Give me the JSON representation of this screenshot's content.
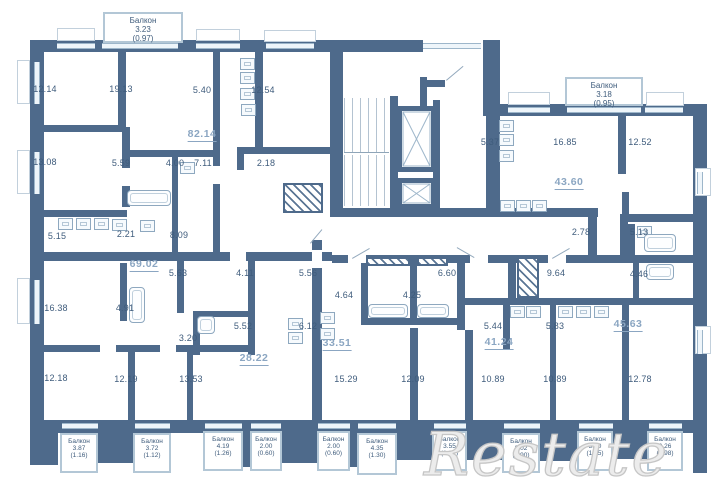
{
  "colors": {
    "wall": "#4e6a8b",
    "room_text": "#3f5c7c",
    "apartment_accent": "#8ba6c2",
    "window": "#9db6ca",
    "watermark": "#c6c6c6"
  },
  "watermark": {
    "text": "Restate"
  },
  "rooms": [
    {
      "label": "12.14",
      "x": 73,
      "y": 90
    },
    {
      "label": "19.13",
      "x": 149,
      "y": 90
    },
    {
      "label": "5.40",
      "x": 230,
      "y": 91
    },
    {
      "label": "12.54",
      "x": 291,
      "y": 91
    },
    {
      "label": "13.08",
      "x": 73,
      "y": 163
    },
    {
      "label": "5.59",
      "x": 149,
      "y": 164
    },
    {
      "label": "4.00",
      "x": 203,
      "y": 164
    },
    {
      "label": "7.11",
      "x": 231,
      "y": 164
    },
    {
      "label": "2.18",
      "x": 294,
      "y": 164
    },
    {
      "label": "5.15",
      "x": 85,
      "y": 237
    },
    {
      "label": "2.21",
      "x": 154,
      "y": 235
    },
    {
      "label": "8.09",
      "x": 207,
      "y": 236
    },
    {
      "label": "5.37",
      "x": 518,
      "y": 143
    },
    {
      "label": "16.85",
      "x": 593,
      "y": 143
    },
    {
      "label": "12.52",
      "x": 668,
      "y": 143
    },
    {
      "label": "2.78",
      "x": 609,
      "y": 233
    },
    {
      "label": "5.13",
      "x": 667,
      "y": 233
    },
    {
      "label": "5.63",
      "x": 206,
      "y": 274
    },
    {
      "label": "4.11",
      "x": 273,
      "y": 274
    },
    {
      "label": "5.56",
      "x": 336,
      "y": 274
    },
    {
      "label": "6.60",
      "x": 475,
      "y": 274
    },
    {
      "label": "9.64",
      "x": 584,
      "y": 274
    },
    {
      "label": "4.46",
      "x": 667,
      "y": 275
    },
    {
      "label": "16.38",
      "x": 84,
      "y": 309
    },
    {
      "label": "4.91",
      "x": 153,
      "y": 309
    },
    {
      "label": "4.64",
      "x": 372,
      "y": 296
    },
    {
      "label": "4.25",
      "x": 440,
      "y": 296
    },
    {
      "label": "3.20",
      "x": 216,
      "y": 339
    },
    {
      "label": "5.52",
      "x": 271,
      "y": 327
    },
    {
      "label": "6.12",
      "x": 336,
      "y": 327
    },
    {
      "label": "5.44",
      "x": 521,
      "y": 327
    },
    {
      "label": "5.83",
      "x": 583,
      "y": 327
    },
    {
      "label": "12.18",
      "x": 84,
      "y": 379
    },
    {
      "label": "12.19",
      "x": 154,
      "y": 380
    },
    {
      "label": "13.53",
      "x": 219,
      "y": 380
    },
    {
      "label": "15.29",
      "x": 374,
      "y": 380
    },
    {
      "label": "12.09",
      "x": 441,
      "y": 380
    },
    {
      "label": "10.89",
      "x": 521,
      "y": 380
    },
    {
      "label": "10.89",
      "x": 583,
      "y": 380
    },
    {
      "label": "12.78",
      "x": 668,
      "y": 380
    }
  ],
  "apartments": [
    {
      "label": "82.14",
      "x": 202,
      "y": 135
    },
    {
      "label": "43.60",
      "x": 569,
      "y": 183
    },
    {
      "label": "69.02",
      "x": 144,
      "y": 265
    },
    {
      "label": "33.51",
      "x": 337,
      "y": 344
    },
    {
      "label": "28.22",
      "x": 254,
      "y": 359
    },
    {
      "label": "41.24",
      "x": 499,
      "y": 343
    },
    {
      "label": "45.63",
      "x": 628,
      "y": 325
    }
  ],
  "balconies_top": [
    {
      "name": "Балкон",
      "area": "3.23",
      "reduced": "(0.97)",
      "x": 103,
      "y": 12,
      "w": 80,
      "h": 31
    },
    {
      "name": "Балкон",
      "area": "3.18",
      "reduced": "(0.95)",
      "x": 565,
      "y": 77,
      "w": 78,
      "h": 29
    }
  ],
  "balconies_bottom": [
    {
      "name": "Балкон",
      "area": "3.87",
      "reduced": "(1.16)",
      "x": 60,
      "y": 433,
      "w": 38,
      "h": 40
    },
    {
      "name": "Балкон",
      "area": "3.72",
      "reduced": "(1.12)",
      "x": 133,
      "y": 433,
      "w": 38,
      "h": 40
    },
    {
      "name": "Балкон",
      "area": "4.19",
      "reduced": "(1.26)",
      "x": 203,
      "y": 431,
      "w": 40,
      "h": 40
    },
    {
      "name": "Балкон",
      "area": "2.00",
      "reduced": "(0.60)",
      "x": 250,
      "y": 431,
      "w": 32,
      "h": 40
    },
    {
      "name": "Балкон",
      "area": "2.00",
      "reduced": "(0.60)",
      "x": 317,
      "y": 431,
      "w": 33,
      "h": 40
    },
    {
      "name": "Балкон",
      "area": "4.35",
      "reduced": "(1.30)",
      "x": 357,
      "y": 433,
      "w": 40,
      "h": 42
    },
    {
      "name": "Балкон",
      "area": "3.55",
      "reduced": "(1.07)",
      "x": 432,
      "y": 431,
      "w": 35,
      "h": 40
    },
    {
      "name": "Балкон",
      "area": "3.02",
      "reduced": "(0.90)",
      "x": 502,
      "y": 433,
      "w": 38,
      "h": 40
    },
    {
      "name": "Балкон",
      "area": "3.50",
      "reduced": "(1.05)",
      "x": 577,
      "y": 431,
      "w": 36,
      "h": 40
    },
    {
      "name": "Балкон",
      "area": "3.26",
      "reduced": "(0.98)",
      "x": 647,
      "y": 431,
      "w": 36,
      "h": 40
    }
  ]
}
